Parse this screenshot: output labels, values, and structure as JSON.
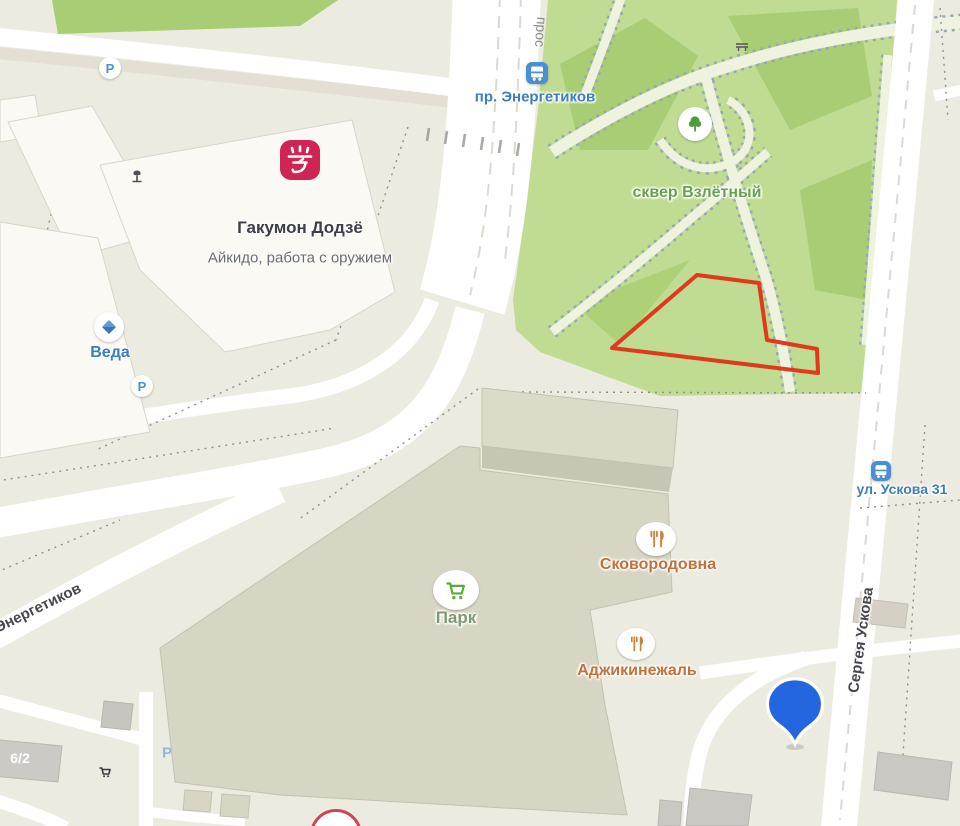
{
  "map": {
    "pois": {
      "dojo": {
        "title": "Гакумон Додзё",
        "subtitle": "Айкидо, работа с оружием"
      },
      "veda": {
        "title": "Веда"
      },
      "skver": {
        "title": "сквер Взлётный"
      },
      "skovorodovna": {
        "title": "Сковородовна"
      },
      "park_store": {
        "title": "Парк"
      },
      "adzhikinezhal": {
        "title": "Аджикинежаль"
      }
    },
    "transit": {
      "stop_energetikov": "пр. Энергетиков",
      "stop_uskova": "ул. Ускова 31"
    },
    "streets": {
      "sergeya_uskova": "Сергея Ускова",
      "energetikov": "Энергетиков",
      "prospekt_fragment": "прос"
    },
    "buildings": {
      "number_6_2": "6/2"
    },
    "badges": {
      "parking": "P",
      "ns_first": "Н",
      "ns_second": "С"
    },
    "colors": {
      "background": "#ecebe0",
      "road": "#ffffff",
      "park_green": "#bfdc92",
      "park_dark_green": "#a8cd74",
      "selection_outline": "#e1391e",
      "placemark_blue": "#2465e0",
      "poi_blue": "#3c7dbf",
      "poi_orange": "#c4703a",
      "poi_green": "#68a24c",
      "dojo_red": "#d22a55",
      "building_gray": "#d7d6c4"
    },
    "icons": [
      "dojo-icon",
      "monument-icon",
      "diamond-icon",
      "parking-icon",
      "bus-stop-icon",
      "tree-icon",
      "restaurant-icon",
      "cart-icon",
      "shop-icon",
      "bench-icon",
      "placemark-icon",
      "ns-logo-icon"
    ]
  }
}
